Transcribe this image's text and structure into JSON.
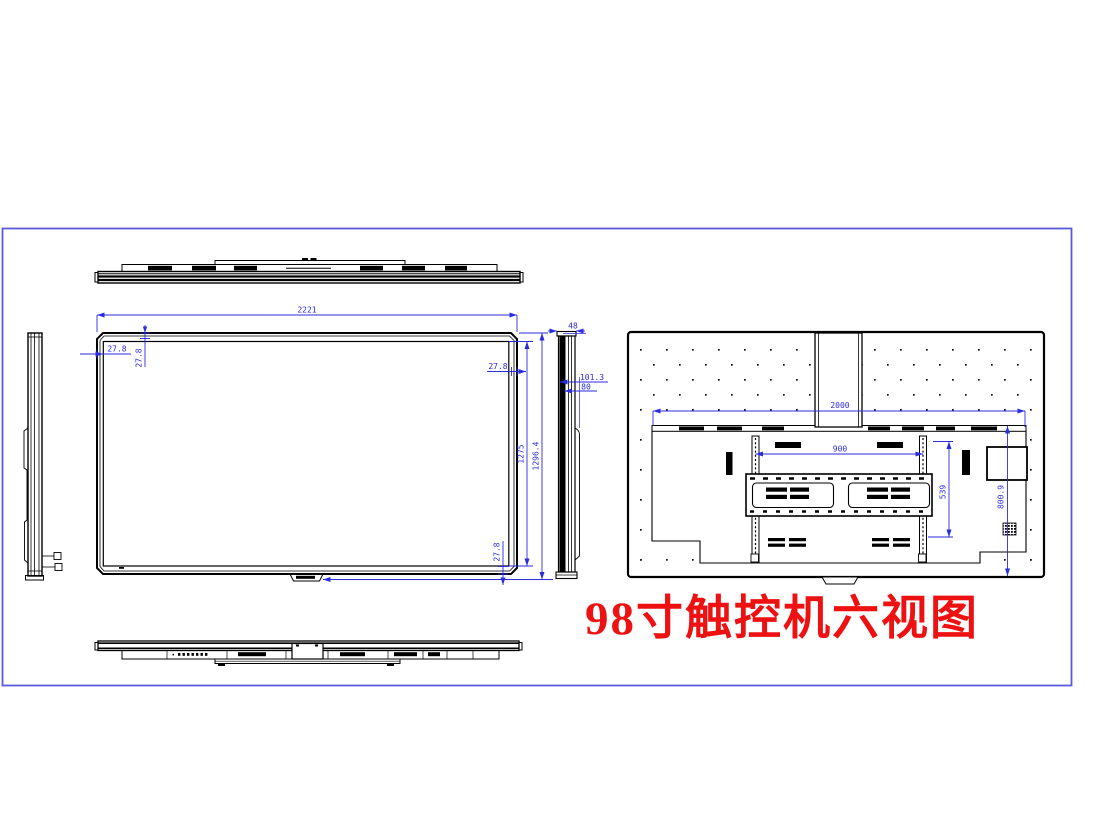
{
  "title": "98寸触控机六视图",
  "drawing": {
    "dimensions": {
      "front_width": "2221",
      "bezel_top_left": "27.8",
      "bezel_top": "27.8",
      "bezel_right": "27.8",
      "bezel_bottom": "27.8",
      "screen_height": "1275",
      "overall_height": "1296.4",
      "depth": "48",
      "depth_with_mount": "101.3",
      "mount_depth": "80",
      "back_width": "2000",
      "vesa_width": "900",
      "vesa_height": "539",
      "back_height": "800.9"
    },
    "colors": {
      "line": "#000000",
      "dimension": "#2b2be0",
      "frame": "#5a5ae0",
      "title": "#ee1111"
    }
  }
}
